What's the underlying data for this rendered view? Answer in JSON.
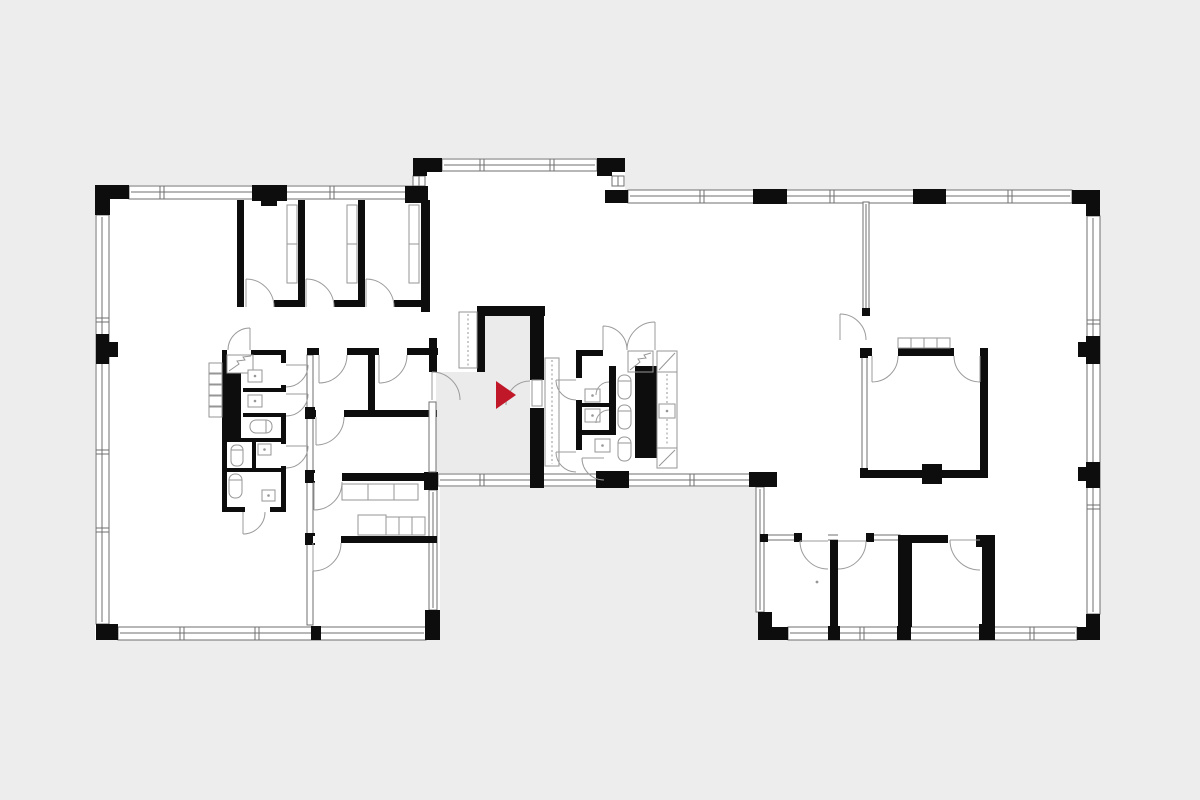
{
  "page": {
    "kind": "architectural-floor-plan",
    "visible_text": "",
    "canvas": {
      "width": 1200,
      "height": 800
    }
  },
  "colors": {
    "background": "#ededed",
    "floor": "#ffffff",
    "wall": "#0d0d0d",
    "window_line": "#6f6f6f",
    "fixture_line": "#969696",
    "door_line": "#9b9b9b",
    "corridor": "#ebebeb",
    "marker": "#c01828"
  },
  "marker": {
    "name": "entrance-arrow",
    "shape": "triangle-pointing-right",
    "color": "#c01828"
  },
  "icon_legend": [
    "toilet-icon",
    "sink-icon",
    "door-swing-icon",
    "duct-shaft-icon",
    "zigzag-shaft-icon",
    "locker-icon",
    "desk-icon",
    "table-icon",
    "window-band",
    "structural-column",
    "entrance-arrow-icon"
  ]
}
